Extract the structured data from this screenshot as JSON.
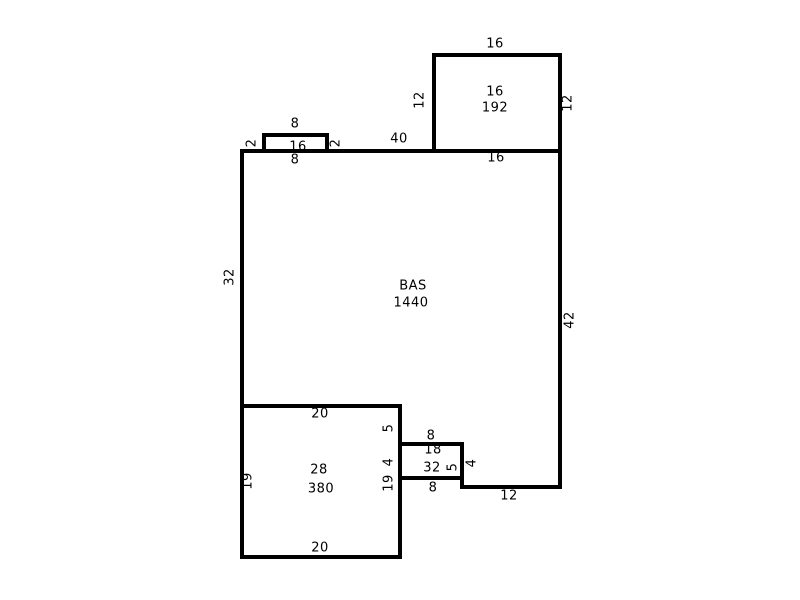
{
  "colors": {
    "line": "#000000",
    "text": "#000000",
    "background": "#ffffff"
  },
  "sketch": {
    "areas": [
      {
        "name": "main-area",
        "label": "BAS",
        "area": "1440"
      },
      {
        "name": "porch-top-right",
        "code": "16",
        "area": "192"
      },
      {
        "name": "addition-bottom-left",
        "code": "28",
        "area": "380"
      },
      {
        "name": "stoop-small",
        "code": "18",
        "area": "32"
      },
      {
        "name": "bump-top",
        "area": "16"
      }
    ],
    "walls": [
      {
        "name": "porch-top-wall",
        "x": 432,
        "y": 53,
        "w": 130,
        "h": 4
      },
      {
        "name": "porch-left-wall",
        "x": 432,
        "y": 53,
        "w": 4,
        "h": 100
      },
      {
        "name": "porch-right-wall",
        "x": 558,
        "y": 53,
        "w": 4,
        "h": 100
      },
      {
        "name": "bump-top-wall",
        "x": 262,
        "y": 133,
        "w": 67,
        "h": 4
      },
      {
        "name": "bump-left-wall",
        "x": 262,
        "y": 133,
        "w": 4,
        "h": 20
      },
      {
        "name": "bump-right-wall",
        "x": 325,
        "y": 133,
        "w": 4,
        "h": 20
      },
      {
        "name": "main-top-wall",
        "x": 240,
        "y": 149,
        "w": 322,
        "h": 4
      },
      {
        "name": "main-left-wall",
        "x": 240,
        "y": 149,
        "w": 4,
        "h": 410
      },
      {
        "name": "main-right-wall",
        "x": 558,
        "y": 149,
        "w": 4,
        "h": 340
      },
      {
        "name": "addition-top-wall",
        "x": 240,
        "y": 404,
        "w": 162,
        "h": 4
      },
      {
        "name": "addition-right-wall",
        "x": 398,
        "y": 404,
        "w": 4,
        "h": 155
      },
      {
        "name": "addition-bottom-wall",
        "x": 240,
        "y": 555,
        "w": 162,
        "h": 4
      },
      {
        "name": "stoop-top-wall",
        "x": 398,
        "y": 442,
        "w": 66,
        "h": 4
      },
      {
        "name": "stoop-bottom-wall",
        "x": 398,
        "y": 476,
        "w": 66,
        "h": 4
      },
      {
        "name": "stoop-right-wall",
        "x": 460,
        "y": 442,
        "w": 4,
        "h": 47
      },
      {
        "name": "main-bottom-wall",
        "x": 460,
        "y": 485,
        "w": 102,
        "h": 4
      }
    ],
    "labels": [
      {
        "name": "dim-porch-top",
        "text": "16",
        "x": 495,
        "y": 44,
        "o": "h"
      },
      {
        "name": "dim-porch-left",
        "text": "12",
        "x": 420,
        "y": 100,
        "o": "v"
      },
      {
        "name": "dim-porch-right",
        "text": "12",
        "x": 568,
        "y": 103,
        "o": "v"
      },
      {
        "name": "porch-code",
        "text": "16",
        "x": 495,
        "y": 92,
        "o": "h"
      },
      {
        "name": "porch-area",
        "text": "192",
        "x": 495,
        "y": 108,
        "o": "h"
      },
      {
        "name": "dim-porch-bottom",
        "text": "16",
        "x": 496,
        "y": 158,
        "o": "h"
      },
      {
        "name": "dim-bump-top",
        "text": "8",
        "x": 295,
        "y": 124,
        "o": "h"
      },
      {
        "name": "dim-bump-left",
        "text": "2",
        "x": 252,
        "y": 143,
        "o": "v"
      },
      {
        "name": "dim-bump-right",
        "text": "2",
        "x": 336,
        "y": 143,
        "o": "v"
      },
      {
        "name": "bump-area",
        "text": "16",
        "x": 298,
        "y": 147,
        "o": "h"
      },
      {
        "name": "dim-bump-bottom",
        "text": "8",
        "x": 295,
        "y": 160,
        "o": "h"
      },
      {
        "name": "dim-main-top",
        "text": "40",
        "x": 399,
        "y": 139,
        "o": "h"
      },
      {
        "name": "dim-main-left",
        "text": "32",
        "x": 230,
        "y": 277,
        "o": "v"
      },
      {
        "name": "main-area-label",
        "text": "BAS",
        "x": 413,
        "y": 286,
        "o": "h"
      },
      {
        "name": "main-area-value",
        "text": "1440",
        "x": 411,
        "y": 303,
        "o": "h"
      },
      {
        "name": "dim-main-right",
        "text": "42",
        "x": 570,
        "y": 320,
        "o": "v"
      },
      {
        "name": "dim-addition-top",
        "text": "20",
        "x": 320,
        "y": 414,
        "o": "h"
      },
      {
        "name": "dim-addition-right-upper",
        "text": "5",
        "x": 389,
        "y": 428,
        "o": "v"
      },
      {
        "name": "dim-stoop-top",
        "text": "8",
        "x": 431,
        "y": 436,
        "o": "h"
      },
      {
        "name": "stoop-code",
        "text": "18",
        "x": 433,
        "y": 450,
        "o": "h"
      },
      {
        "name": "stoop-area",
        "text": "32",
        "x": 432,
        "y": 468,
        "o": "h"
      },
      {
        "name": "dim-stoop-inner",
        "text": "5",
        "x": 453,
        "y": 467,
        "o": "v"
      },
      {
        "name": "dim-stoop-left",
        "text": "4",
        "x": 389,
        "y": 462,
        "o": "v"
      },
      {
        "name": "dim-stoop-right",
        "text": "4",
        "x": 472,
        "y": 463,
        "o": "v"
      },
      {
        "name": "dim-addition-right",
        "text": "19",
        "x": 389,
        "y": 483,
        "o": "v"
      },
      {
        "name": "dim-addition-left",
        "text": "19",
        "x": 248,
        "y": 481,
        "o": "v"
      },
      {
        "name": "dim-stoop-bottom",
        "text": "8",
        "x": 433,
        "y": 488,
        "o": "h"
      },
      {
        "name": "dim-main-bottom",
        "text": "12",
        "x": 509,
        "y": 496,
        "o": "h"
      },
      {
        "name": "addition-code",
        "text": "28",
        "x": 319,
        "y": 470,
        "o": "h"
      },
      {
        "name": "addition-area",
        "text": "380",
        "x": 321,
        "y": 489,
        "o": "h"
      },
      {
        "name": "dim-addition-bottom",
        "text": "20",
        "x": 320,
        "y": 548,
        "o": "h"
      }
    ]
  }
}
